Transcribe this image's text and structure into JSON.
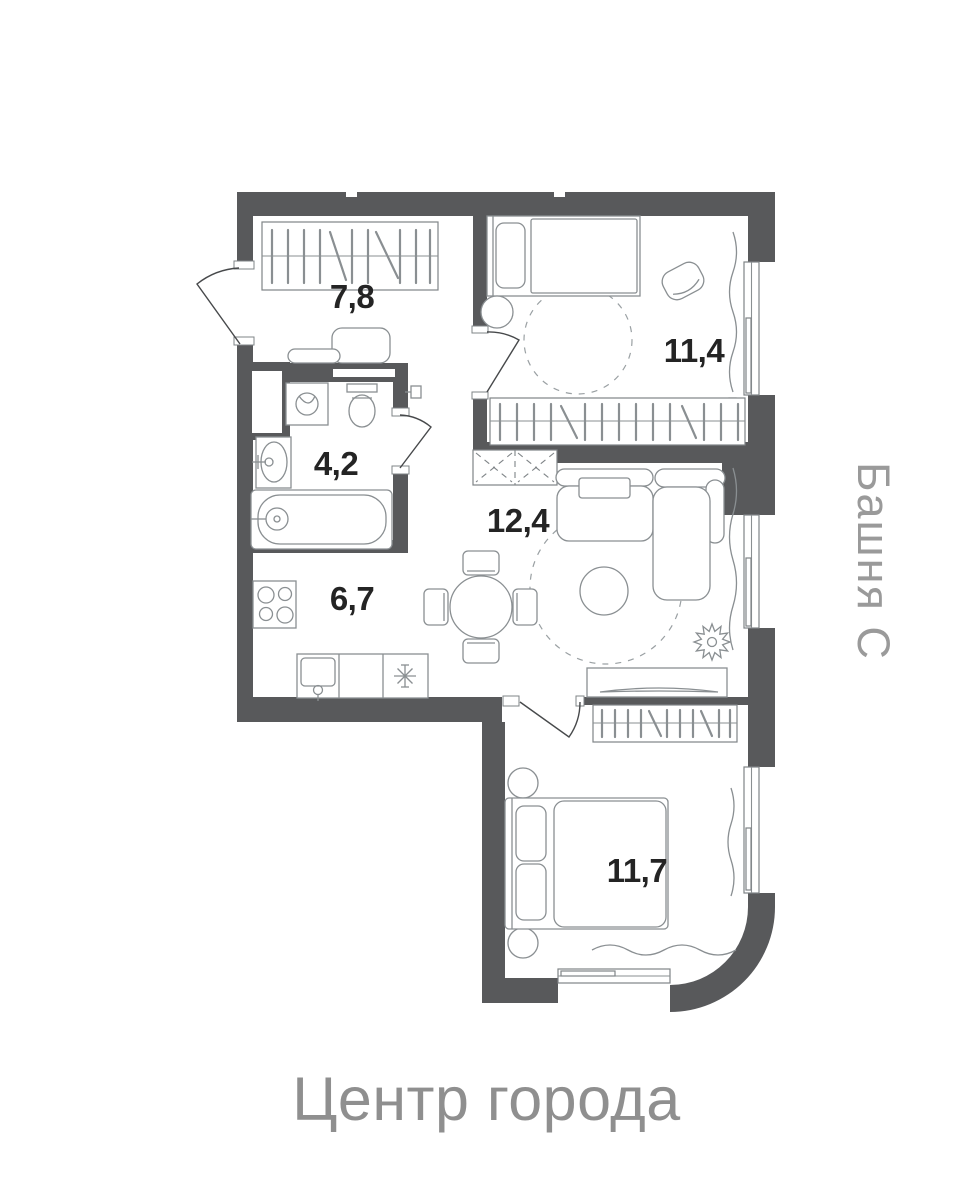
{
  "labels": {
    "tower": "Башня С",
    "district": "Центр города"
  },
  "rooms": [
    {
      "id": "hallway",
      "area": "7,8"
    },
    {
      "id": "bedroom-1",
      "area": "11,4"
    },
    {
      "id": "bathroom",
      "area": "4,2"
    },
    {
      "id": "living-room",
      "area": "12,4"
    },
    {
      "id": "kitchen",
      "area": "6,7"
    },
    {
      "id": "bedroom-2",
      "area": "11,7"
    }
  ],
  "colors": {
    "wall": "#58595b",
    "furniture_line": "#8a8f92",
    "room_label": "#242424",
    "caption_text": "#8f8f8f",
    "background": "#ffffff"
  }
}
